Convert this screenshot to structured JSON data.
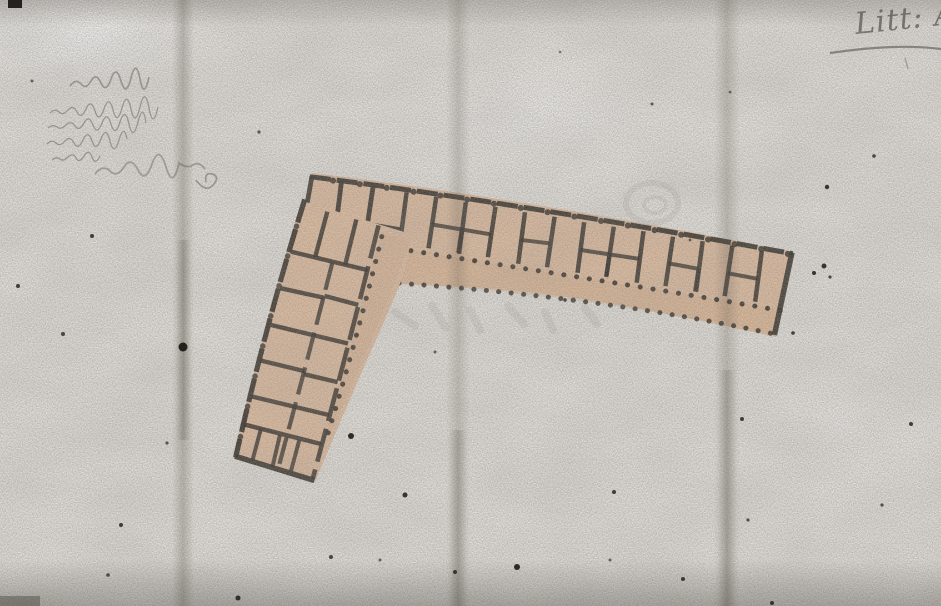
{
  "canvas": {
    "width_px": 941,
    "height_px": 606
  },
  "paper": {
    "base_color": "#eae7e2",
    "fold_color": "#575349",
    "fold_line_count": 3
  },
  "annotations": {
    "corner_mark": "Litt: A",
    "corner_mark_style": "faint cursive, underlined, clipped at right edge",
    "note_lines_count": 6,
    "note_legibility": "illegible faded handwriting"
  },
  "plan": {
    "wash_color": "#e6c2a4",
    "wash_shadow_color": "#d8ab86",
    "ink_color": "#2e2923",
    "long_wing_cell_count": 13,
    "short_wing_row_count": 7,
    "gallery_marking": "dotted colonnade lines along courtyard sides"
  }
}
